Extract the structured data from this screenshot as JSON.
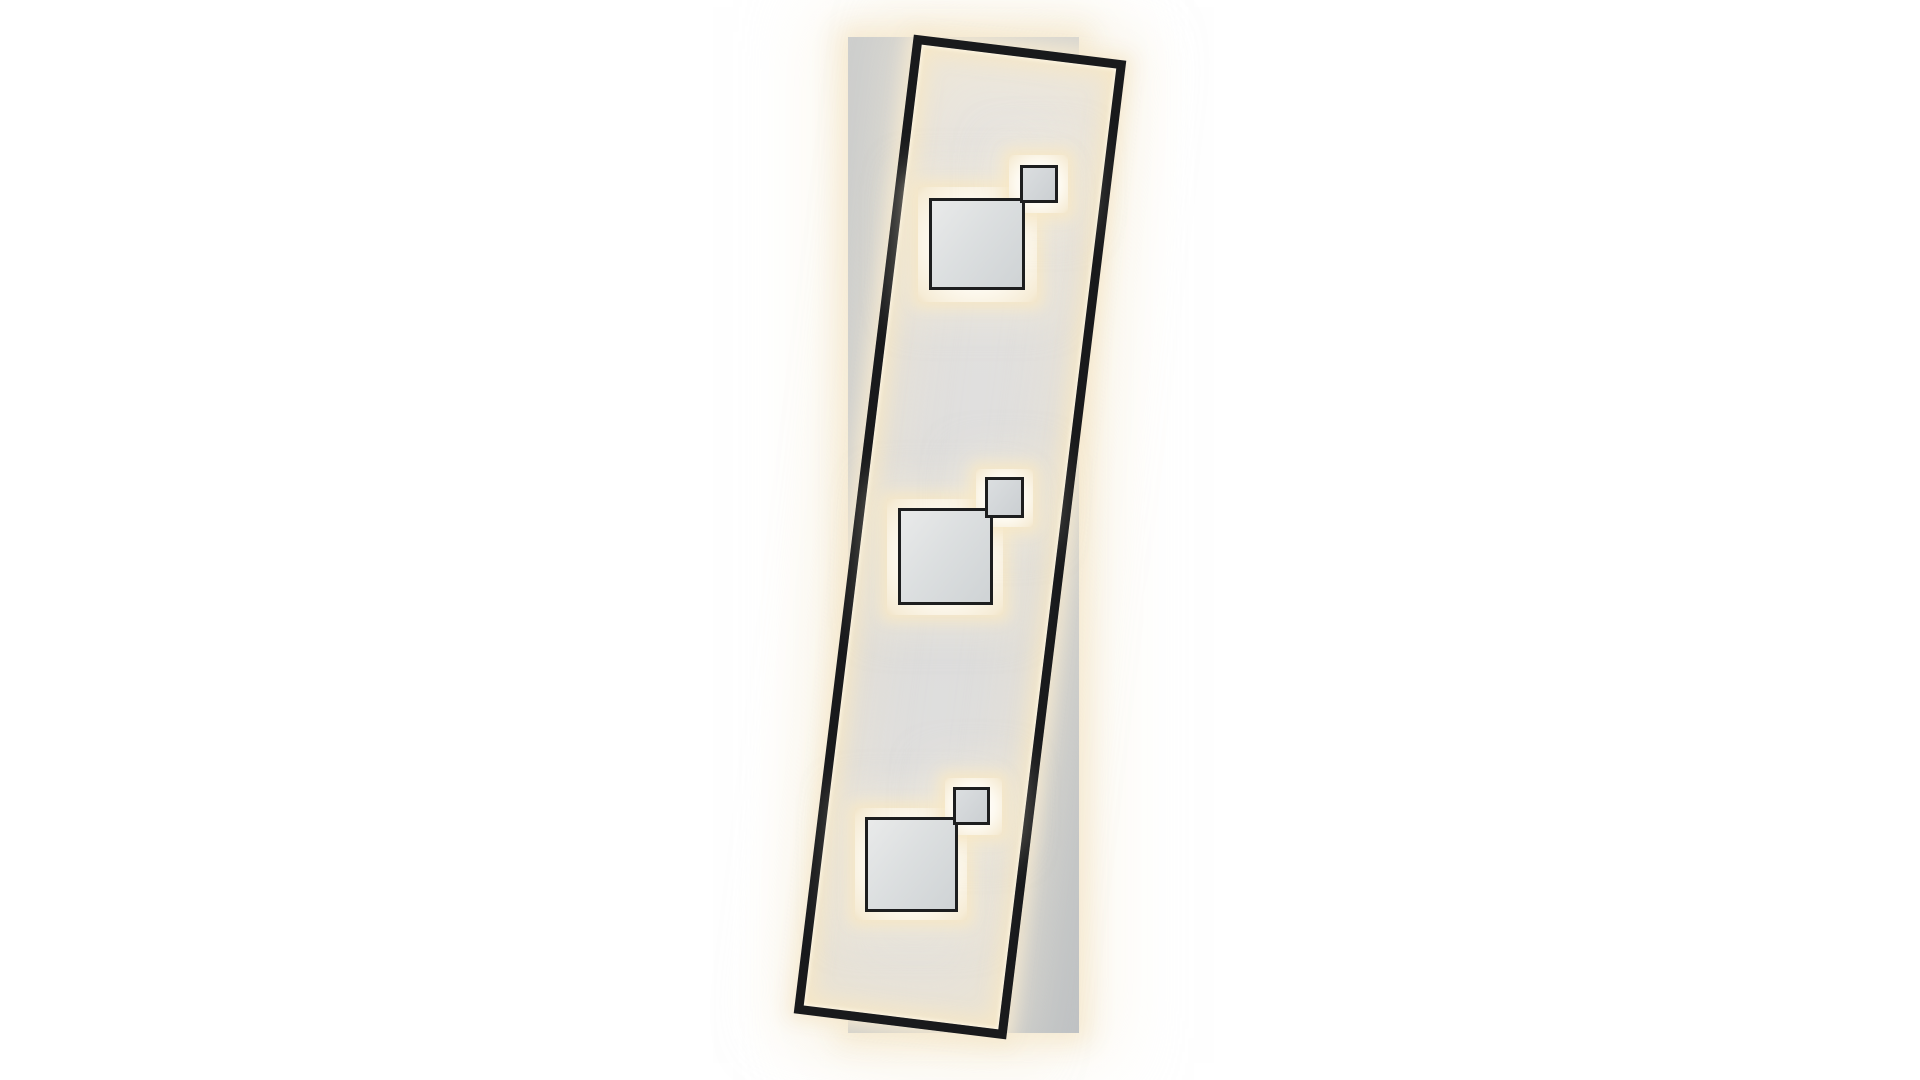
{
  "meta": {
    "description": "Product photo of a rectangular LED ceiling lamp: tilted black metal frame with edge-lit warm-white LEDs, three square light modules (one large, one small each) on glowing plates, mounted over a straight light-gray backing panel, on a plain white background.",
    "canvas": {
      "width": 1920,
      "height": 1080,
      "background": "#ffffff"
    }
  },
  "scene": {
    "colors": {
      "background": "#ffffff",
      "panel_gradient": [
        "#cdcecd",
        "#c6c8c9",
        "#bfc2c4"
      ],
      "frame_border": "#191a1c",
      "frame_surface": [
        "#ece8e1",
        "#e3e1df",
        "#e0dfde",
        "#dcdcdc",
        "#e7e3db"
      ],
      "led_bright": "#fff9ea",
      "led_warm": "rgba(246,231,197,0.92)",
      "led_faint": "rgba(241,229,203,0.42)",
      "halo_strong": "rgba(245,233,208,0.95)",
      "halo_soft": "rgba(247,239,219,0.50)",
      "plate_core": "#ffffff",
      "plate_mid": "#fdf9ef",
      "plate_edge": "#f6ecd6",
      "plate_rim": "#f1e4c8",
      "square_border": "#1d1e1f",
      "square_large_fill": [
        "#e9eaea",
        "#dcdfe0",
        "#cfd3d5"
      ],
      "square_small_fill": [
        "#dbdee0",
        "#cbcfd2"
      ]
    },
    "back_panel": {
      "x": 848,
      "y": 37,
      "width": 231,
      "height": 996
    },
    "frame": {
      "x": 853,
      "y": 44,
      "width": 214,
      "height": 986,
      "rotation_deg": 7,
      "border_width": 9
    },
    "square_border_width": 3,
    "clusters": [
      {
        "name": "top",
        "plate_large": {
          "x": 918,
          "y": 187,
          "width": 119,
          "height": 115
        },
        "plate_small": {
          "x": 1009,
          "y": 155,
          "width": 59,
          "height": 58
        },
        "square_large": {
          "x": 929,
          "y": 198,
          "width": 96,
          "height": 92
        },
        "square_small": {
          "x": 1020,
          "y": 165,
          "width": 38,
          "height": 38
        }
      },
      {
        "name": "middle",
        "plate_large": {
          "x": 887,
          "y": 499,
          "width": 116,
          "height": 116
        },
        "plate_small": {
          "x": 976,
          "y": 469,
          "width": 57,
          "height": 58
        },
        "square_large": {
          "x": 898,
          "y": 508,
          "width": 95,
          "height": 97
        },
        "square_small": {
          "x": 985,
          "y": 477,
          "width": 39,
          "height": 41
        }
      },
      {
        "name": "bottom",
        "plate_large": {
          "x": 855,
          "y": 808,
          "width": 112,
          "height": 112
        },
        "plate_small": {
          "x": 945,
          "y": 778,
          "width": 57,
          "height": 57
        },
        "square_large": {
          "x": 865,
          "y": 817,
          "width": 93,
          "height": 95
        },
        "square_small": {
          "x": 953,
          "y": 787,
          "width": 37,
          "height": 38
        }
      }
    ]
  }
}
